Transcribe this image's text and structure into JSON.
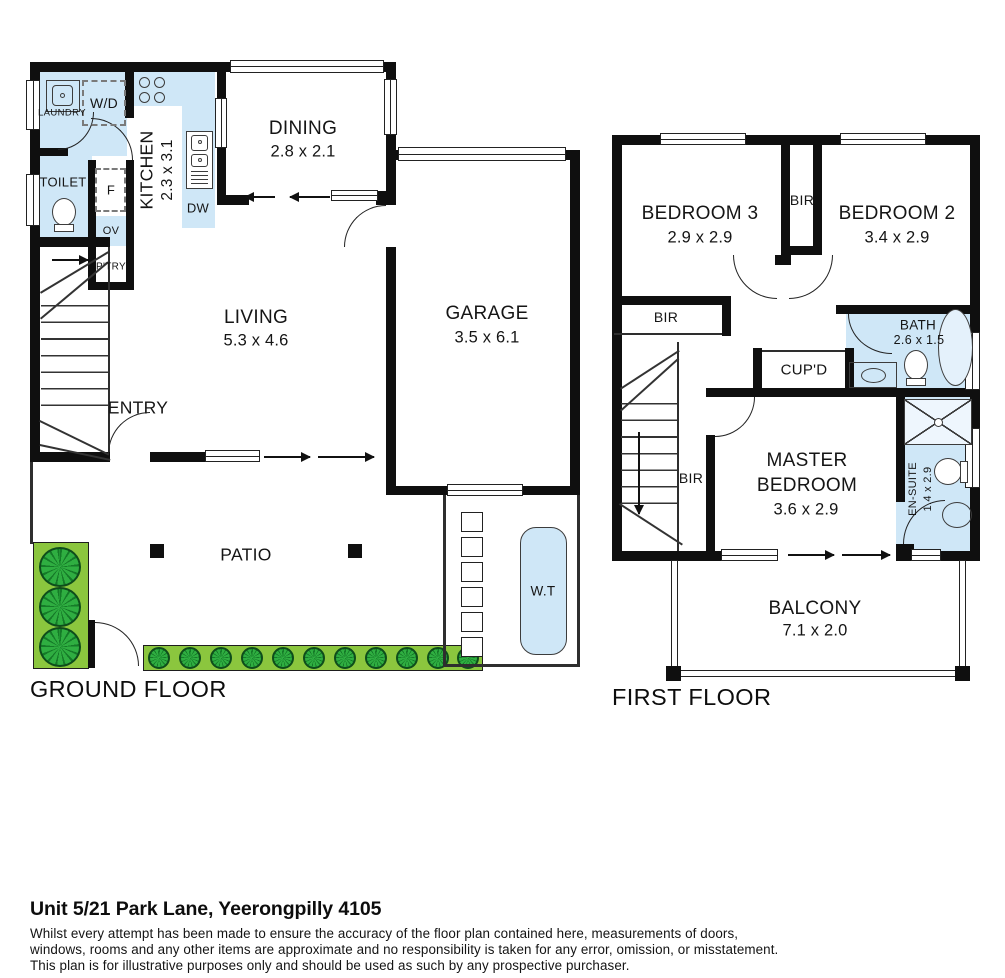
{
  "colors": {
    "wall": "#0f0f0f",
    "wet_area_blue": "#cfe7f7",
    "garden_green": "#8bc63e",
    "bush_green": "#2fae41"
  },
  "ground_floor": {
    "label": "GROUND FLOOR",
    "laundry": "LAUNDRY",
    "washer_dryer": "W/D",
    "toilet": "TOILET",
    "fridge": "F",
    "oven": "OV",
    "pantry": "P'TRY",
    "kitchen_name": "KITCHEN",
    "kitchen_dims": "2.3 x 3.1",
    "dishwasher": "DW",
    "dining_name": "DINING",
    "dining_dims": "2.8 x 2.1",
    "living_name": "LIVING",
    "living_dims": "5.3 x 4.6",
    "garage_name": "GARAGE",
    "garage_dims": "3.5 x 6.1",
    "entry": "ENTRY",
    "patio": "PATIO",
    "water_tank": "W.T"
  },
  "first_floor": {
    "label": "FIRST FLOOR",
    "bedroom3_name": "BEDROOM 3",
    "bedroom3_dims": "2.9 x 2.9",
    "bedroom2_name": "BEDROOM 2",
    "bedroom2_dims": "3.4 x 2.9",
    "bir_top": "BIR",
    "bir_mid": "BIR",
    "bir_lower": "BIR",
    "bath_name": "BATH",
    "bath_dims": "2.6 x 1.5",
    "cupboard": "CUP'D",
    "master_line1": "MASTER",
    "master_line2": "BEDROOM",
    "master_dims": "3.6 x 2.9",
    "ensuite_name": "EN-SUITE",
    "ensuite_dims": "1.4 x 2.9",
    "balcony_name": "BALCONY",
    "balcony_dims": "7.1 x 2.0"
  },
  "footer": {
    "address": "Unit 5/21 Park Lane, Yeerongpilly 4105",
    "disclaimer_line1": "Whilst every attempt has been made to ensure the accuracy of the floor plan contained here, measurements of doors,",
    "disclaimer_line2": "windows, rooms and any other items are approximate and no responsibility is taken for any error, omission, or misstatement.",
    "disclaimer_line3": "This plan is for illustrative purposes only and should be used as such by any prospective purchaser."
  }
}
